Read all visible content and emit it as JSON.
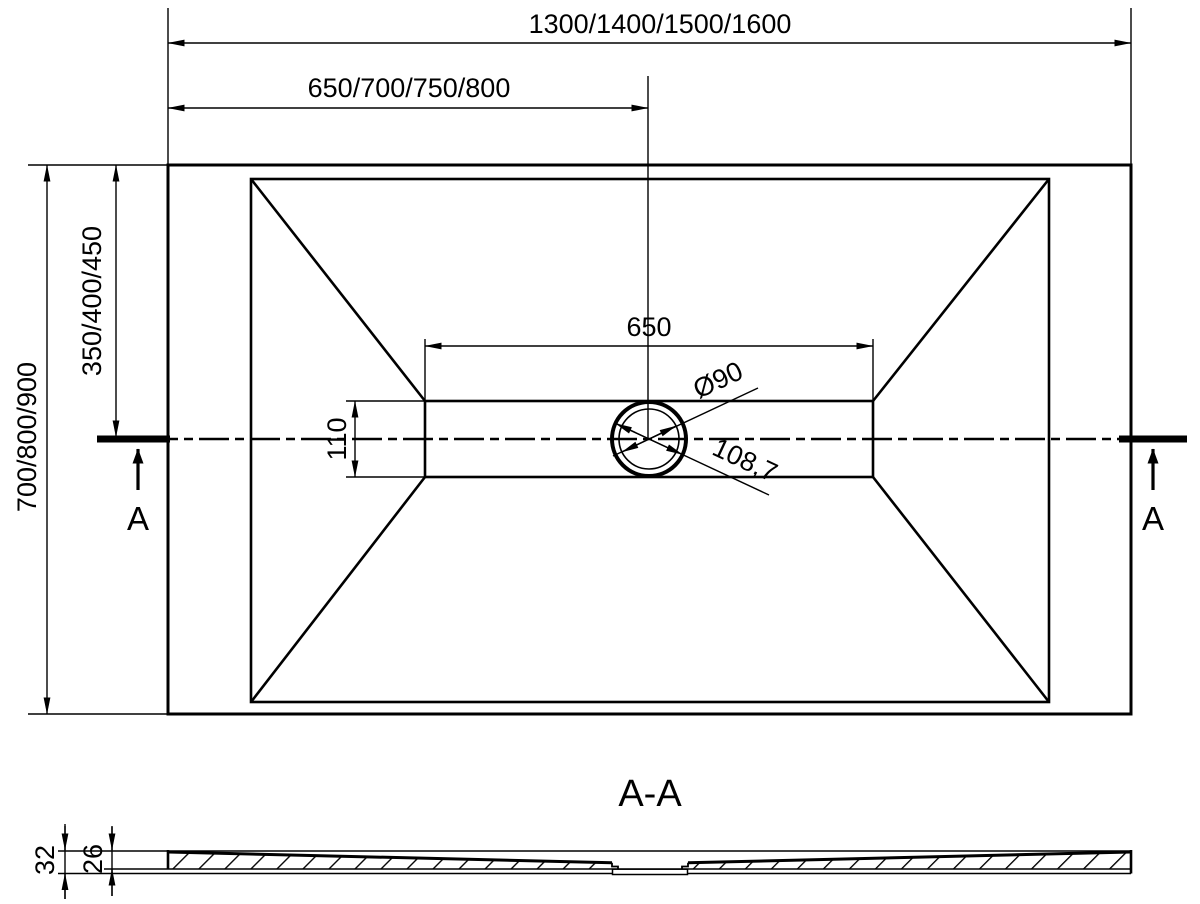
{
  "plan_view": {
    "overall_width": "1300/1400/1500/1600",
    "width_to_drain_center": "650/700/750/800",
    "overall_depth": "700/800/900",
    "depth_to_drain_center": "350/400/450",
    "channel_length": "650",
    "channel_width": "110",
    "drain_diameter": "Ø90",
    "drain_flange_diameter": "108,7",
    "section_label_left": "A",
    "section_label_right": "A"
  },
  "section_view": {
    "title": "A-A",
    "edge_thickness": "32",
    "core_thickness": "26"
  },
  "colors": {
    "line": "#000000",
    "background": "#ffffff"
  }
}
